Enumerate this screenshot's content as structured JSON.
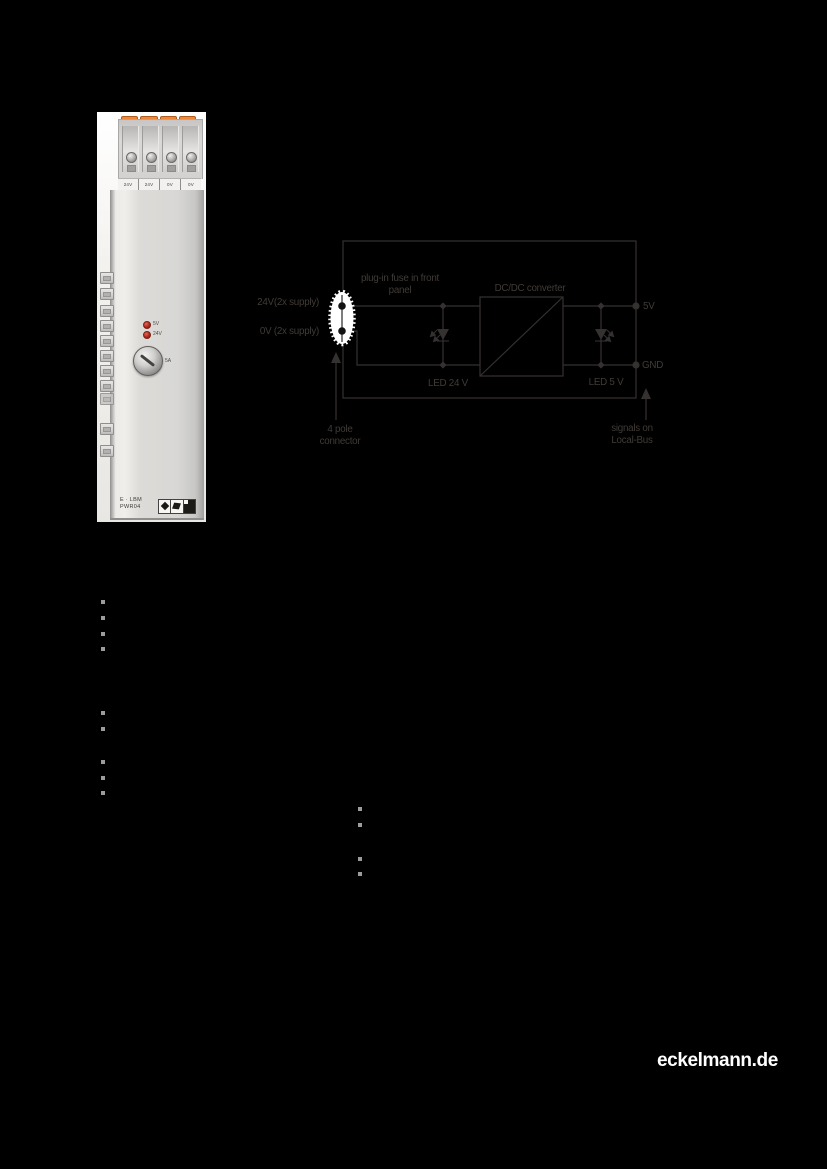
{
  "page": {
    "background_color": "#000000"
  },
  "photo": {
    "terminal_labels": [
      "24V",
      "24V",
      "0V",
      "0V"
    ],
    "led_labels": [
      "5V",
      "24V"
    ],
    "fuse_label": "5A",
    "device_label_line1": "E · LBM",
    "device_label_line2": "PWR04",
    "certification_icons": [
      "diamond",
      "tilted-square",
      "filled-square"
    ],
    "colors": {
      "clamp_orange": "#e8762e",
      "body_gray": "#d7d6d4",
      "led_red": "#b02a1c"
    }
  },
  "diagram": {
    "stroke_color": "#353130",
    "highlight_color": "#ffffff",
    "labels": {
      "fuse_line1": "plug-in fuse in front",
      "fuse_line2": "panel",
      "converter": "DC/DC converter",
      "supply_24v": "24V(2x supply)",
      "supply_0v": "0V (2x supply)",
      "output_5v": "5V",
      "output_gnd": "GND",
      "led_24v": "LED 24 V",
      "led_5v": "LED 5 V",
      "connector_line1": "4 pole",
      "connector_line2": "connector",
      "bus_line1": "signals on",
      "bus_line2": "Local-Bus"
    }
  },
  "bullets": {
    "color": "#9c9c9c",
    "count": 13
  },
  "footer": {
    "logo_text": "eckelmann.de"
  }
}
